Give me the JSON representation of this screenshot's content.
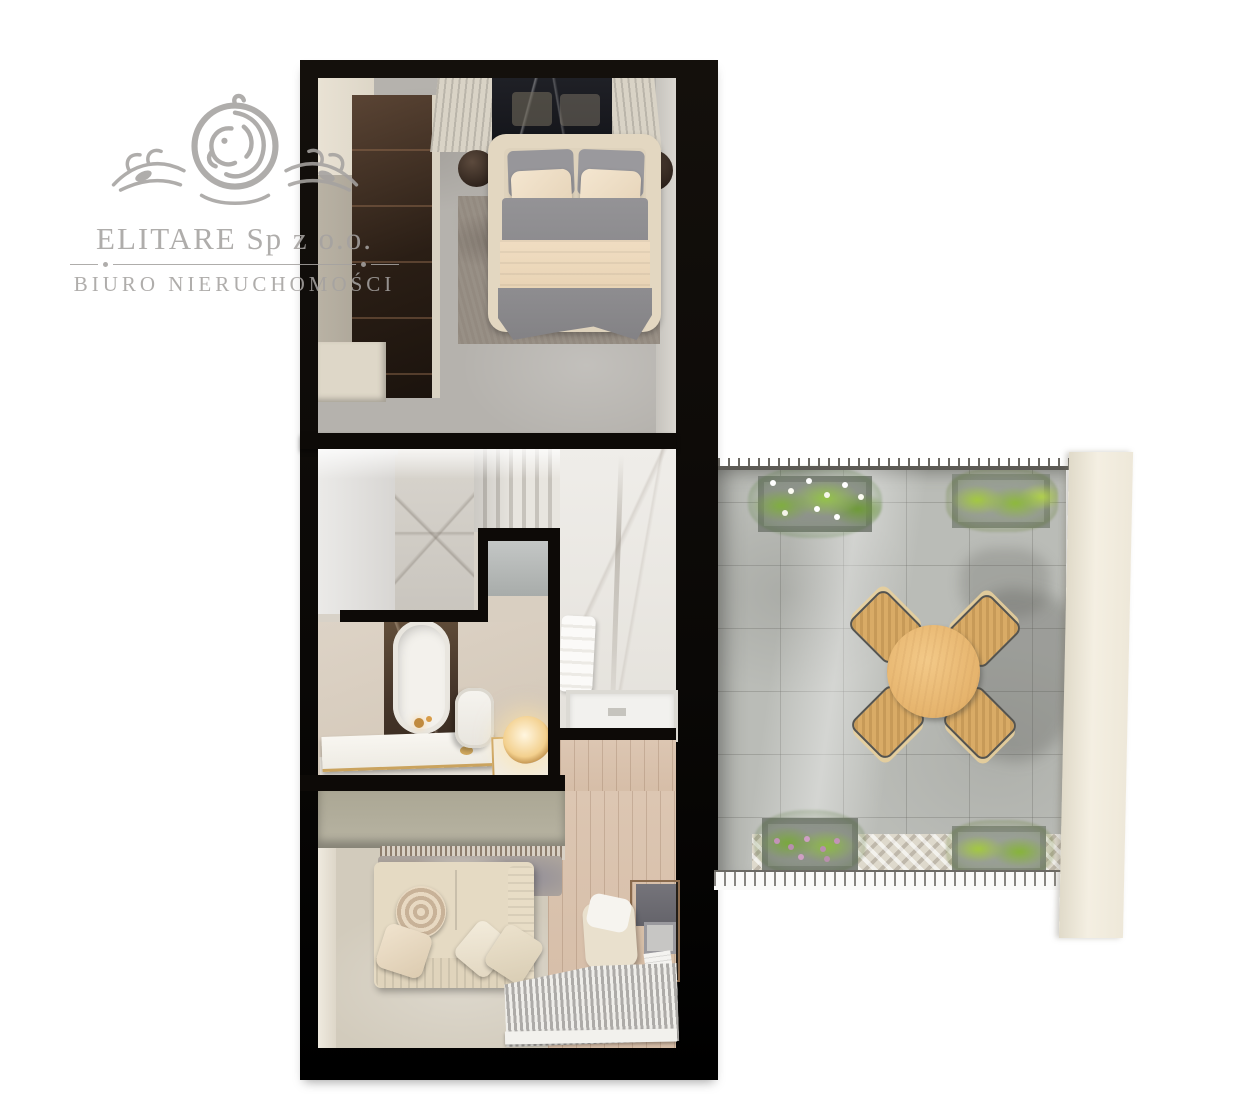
{
  "watermark": {
    "company": "ELITARE Sp z o.o.",
    "subtitle": "BIURO NIERUCHOMOŚCI",
    "logo_icon": "lion-crest-icon",
    "color": "#a5a2a0"
  },
  "floorplan": {
    "kind": "apartment top-down 3D render, upper floor with terrace",
    "rooms": [
      {
        "name": "bedroom",
        "items": [
          "wardrobe",
          "double-bed",
          "headboard-marble-panel",
          "nightstand-left",
          "nightstand-right",
          "area-rug"
        ]
      },
      {
        "name": "staircase",
        "items": [
          "marble-stairs",
          "marble-wall"
        ]
      },
      {
        "name": "bathroom",
        "items": [
          "freestanding-bathtub",
          "gold-faucet",
          "toilet",
          "vanity-counter",
          "glow-table-lamp",
          "mirror"
        ]
      },
      {
        "name": "shower-room",
        "items": [
          "shower-tray",
          "towel"
        ]
      },
      {
        "name": "hallway",
        "items": [
          "wood-floor"
        ]
      },
      {
        "name": "living-room",
        "items": [
          "sideboard",
          "fringe-curtain",
          "throw-blanket",
          "sofa",
          "decor-pillows",
          "desk",
          "desk-chair",
          "laptop",
          "striped-rug",
          "lounge-chair"
        ]
      },
      {
        "name": "terrace",
        "items": [
          "stone-tile-paving",
          "herringbone-paving-strip",
          "round-dining-table",
          "dining-chair-nw",
          "dining-chair-ne",
          "dining-chair-sw",
          "dining-chair-se",
          "planter-top-left",
          "planter-top-right",
          "planter-bottom-left",
          "planter-bottom-right",
          "railing-top",
          "railing-bottom",
          "neighbor-wall-panel"
        ]
      }
    ],
    "palette": {
      "walls_black": "#0d0a07",
      "concrete_floor": "#b5b2ad",
      "wood_floor": "#d8c1ae",
      "sofa_cream": "#e5dac3",
      "sideboard_green_beige": "#b6b2a1",
      "duvet_gray": "#8e8d90",
      "blanket_cream": "#eedcc1",
      "tub_surround_brown": "#5b4733",
      "gold_accent": "#c9a05c",
      "terrace_paving": "#b9bbb6",
      "table_wood": "#eec078",
      "chair_wood": "#d9ab66",
      "plant_green": "#86b23c",
      "neighbor_wall_cream": "#f0ead9"
    }
  }
}
